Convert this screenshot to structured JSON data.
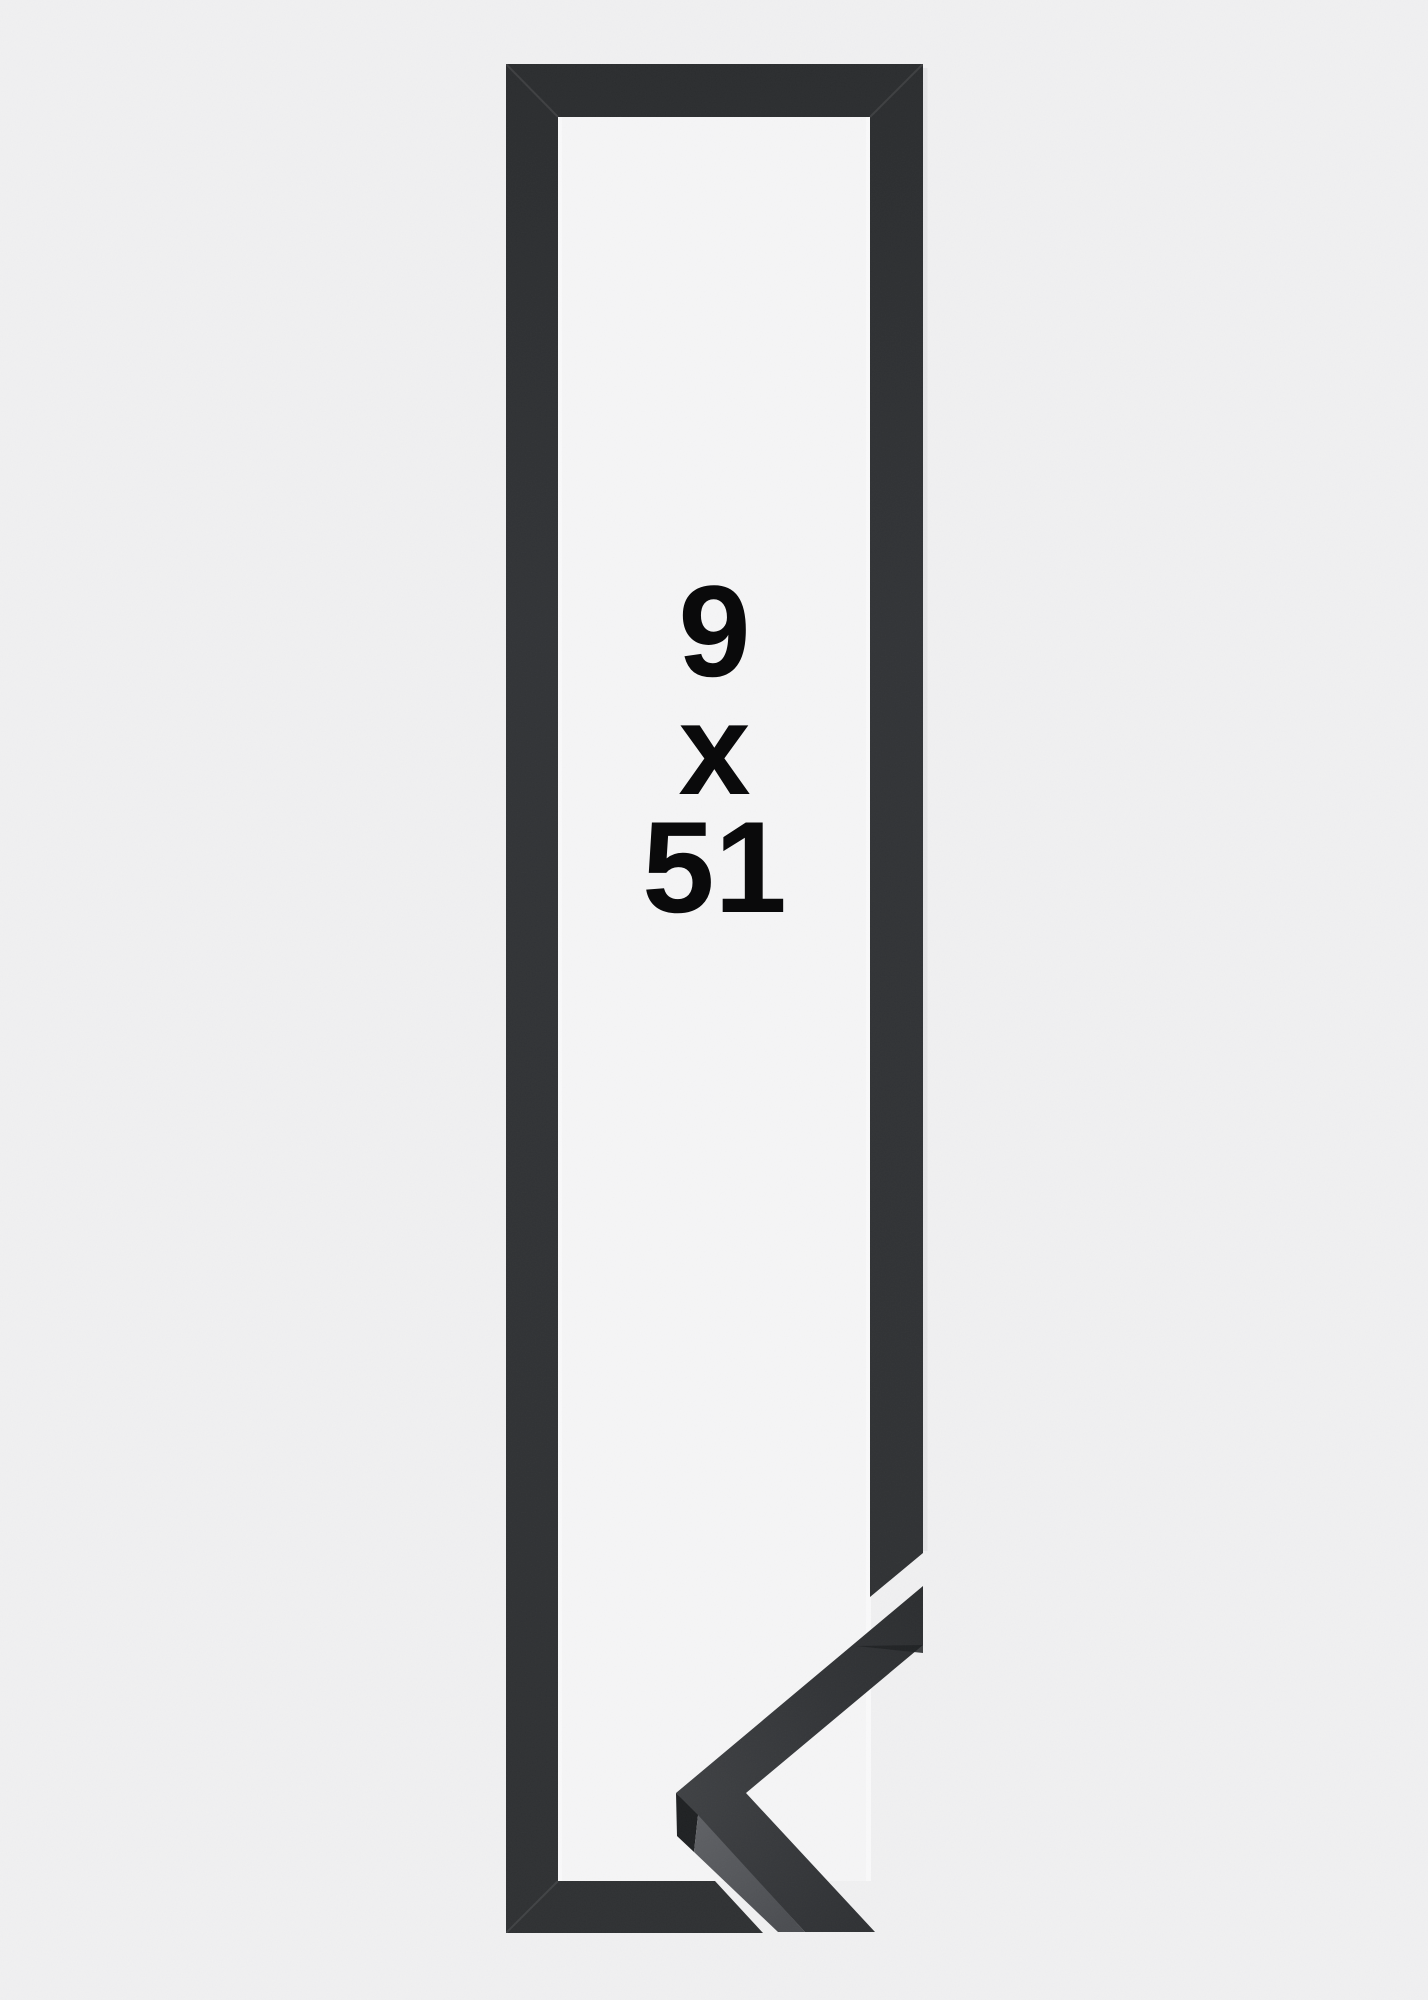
{
  "size_label": {
    "width": "9",
    "separator": "x",
    "height": "51"
  },
  "colors": {
    "background": "#f0f0f1",
    "frame_opening": "#f5f5f6",
    "opening_edge_light": "#fafafb",
    "frame_face": "#323437",
    "frame_face_dark": "#2b2d2f",
    "frame_face_bottom": "#2f3133",
    "moulding_sheen": "#3f4144",
    "moulding_side_light": "#5f6165",
    "moulding_side_dark": "#4b4d51",
    "moulding_end_face": "#1f2123",
    "edge_highlight": "#e2e2e4",
    "label_text": "#0a0a0b"
  }
}
